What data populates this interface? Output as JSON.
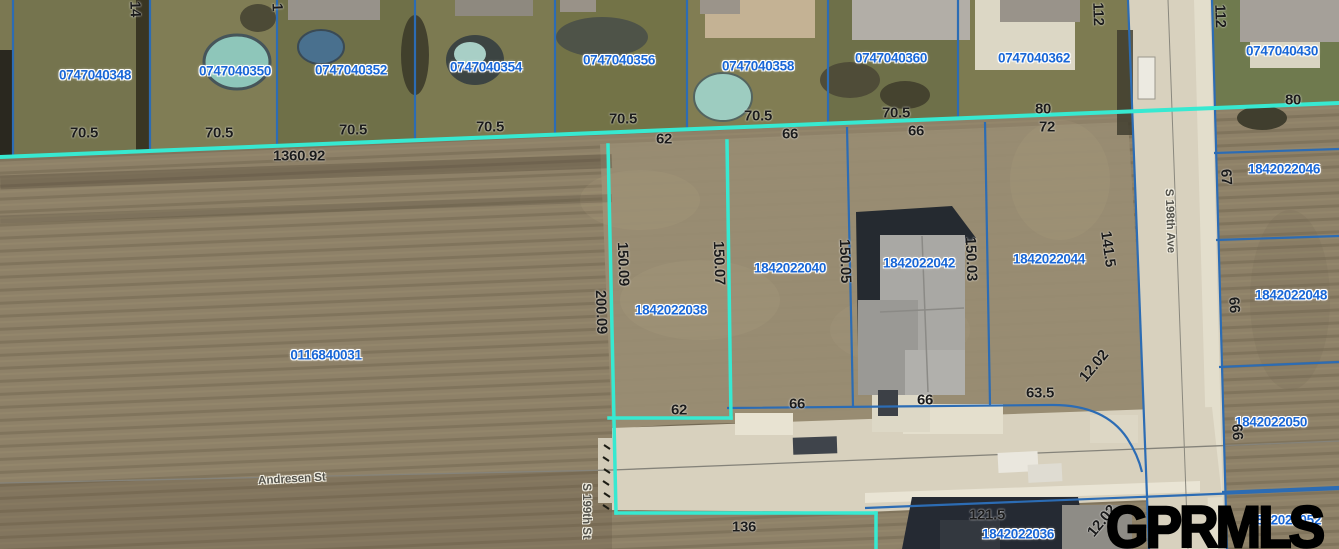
{
  "map": {
    "watermark": "GPRMLS",
    "colors": {
      "parcel_line_blue": "#2c6cb4",
      "highlight_cyan": "#37e9d1",
      "parcel_label_blue": "#1866d6",
      "dimension_label_dark": "#1b1b1b",
      "street_label_gray": "#53524b",
      "watermark_black": "#000000",
      "road_pavement": "#d8d1be",
      "field_brown": "#8e8168",
      "lawn_green": "#7b7852"
    },
    "parcel_labels": [
      {
        "text": "0747040348",
        "x": 95,
        "y": 75
      },
      {
        "text": "0747040350",
        "x": 235,
        "y": 71
      },
      {
        "text": "0747040352",
        "x": 351,
        "y": 70
      },
      {
        "text": "0747040354",
        "x": 486,
        "y": 67
      },
      {
        "text": "0747040356",
        "x": 619,
        "y": 60
      },
      {
        "text": "0747040358",
        "x": 758,
        "y": 66
      },
      {
        "text": "0747040360",
        "x": 891,
        "y": 58
      },
      {
        "text": "0747040362",
        "x": 1034,
        "y": 58
      },
      {
        "text": "0747040430",
        "x": 1282,
        "y": 51
      },
      {
        "text": "1842022038",
        "x": 671,
        "y": 310
      },
      {
        "text": "1842022040",
        "x": 790,
        "y": 268
      },
      {
        "text": "1842022042",
        "x": 919,
        "y": 263
      },
      {
        "text": "1842022044",
        "x": 1049,
        "y": 259
      },
      {
        "text": "0116840031",
        "x": 326,
        "y": 355
      },
      {
        "text": "1842022046",
        "x": 1284,
        "y": 169
      },
      {
        "text": "1842022048",
        "x": 1291,
        "y": 295
      },
      {
        "text": "1842022050",
        "x": 1271,
        "y": 422
      },
      {
        "text": "1842022036",
        "x": 1018,
        "y": 534
      },
      {
        "text": "1842022052",
        "x": 1285,
        "y": 520
      }
    ],
    "dimension_labels": [
      {
        "text": "70.5",
        "x": 84,
        "y": 133
      },
      {
        "text": "70.5",
        "x": 219,
        "y": 133
      },
      {
        "text": "70.5",
        "x": 353,
        "y": 130
      },
      {
        "text": "70.5",
        "x": 490,
        "y": 127
      },
      {
        "text": "70.5",
        "x": 623,
        "y": 119
      },
      {
        "text": "70.5",
        "x": 758,
        "y": 116
      },
      {
        "text": "70.5",
        "x": 896,
        "y": 113
      },
      {
        "text": "80",
        "x": 1043,
        "y": 109
      },
      {
        "text": "80",
        "x": 1293,
        "y": 100
      },
      {
        "text": "1360.92",
        "x": 299,
        "y": 156
      },
      {
        "text": "62",
        "x": 664,
        "y": 139
      },
      {
        "text": "66",
        "x": 790,
        "y": 134
      },
      {
        "text": "66",
        "x": 916,
        "y": 131
      },
      {
        "text": "72",
        "x": 1047,
        "y": 127
      },
      {
        "text": "112",
        "x": 1098,
        "y": 14,
        "rot": 88
      },
      {
        "text": "112",
        "x": 1220,
        "y": 16,
        "rot": 88
      },
      {
        "text": "14",
        "x": 135,
        "y": 9,
        "rot": 88
      },
      {
        "text": "1",
        "x": 277,
        "y": 7,
        "rot": 88
      },
      {
        "text": "67",
        "x": 1226,
        "y": 177,
        "rot": 86
      },
      {
        "text": "66",
        "x": 1234,
        "y": 305,
        "rot": 86
      },
      {
        "text": "66",
        "x": 1237,
        "y": 432,
        "rot": 86
      },
      {
        "text": "200.09",
        "x": 601,
        "y": 312,
        "rot": 88
      },
      {
        "text": "150.09",
        "x": 623,
        "y": 264,
        "rot": 88
      },
      {
        "text": "150.07",
        "x": 719,
        "y": 263,
        "rot": 88
      },
      {
        "text": "150.05",
        "x": 845,
        "y": 261,
        "rot": 88
      },
      {
        "text": "150.03",
        "x": 971,
        "y": 259,
        "rot": 88
      },
      {
        "text": "141.5",
        "x": 1108,
        "y": 249,
        "rot": 82
      },
      {
        "text": "12.02",
        "x": 1094,
        "y": 366,
        "rot": -50
      },
      {
        "text": "62",
        "x": 679,
        "y": 410
      },
      {
        "text": "66",
        "x": 797,
        "y": 404
      },
      {
        "text": "66",
        "x": 925,
        "y": 400
      },
      {
        "text": "63.5",
        "x": 1040,
        "y": 393
      },
      {
        "text": "136",
        "x": 744,
        "y": 527
      },
      {
        "text": "121.5",
        "x": 987,
        "y": 515
      },
      {
        "text": "12.02",
        "x": 1102,
        "y": 521,
        "rot": -50
      }
    ],
    "street_labels": [
      {
        "text": "Andresen St",
        "x": 292,
        "y": 480,
        "rot": -3
      },
      {
        "text": "S 199th St",
        "x": 585,
        "y": 511,
        "rot": 90
      },
      {
        "text": "S 198th Ave",
        "x": 1169,
        "y": 221,
        "rot": 88
      }
    ]
  }
}
